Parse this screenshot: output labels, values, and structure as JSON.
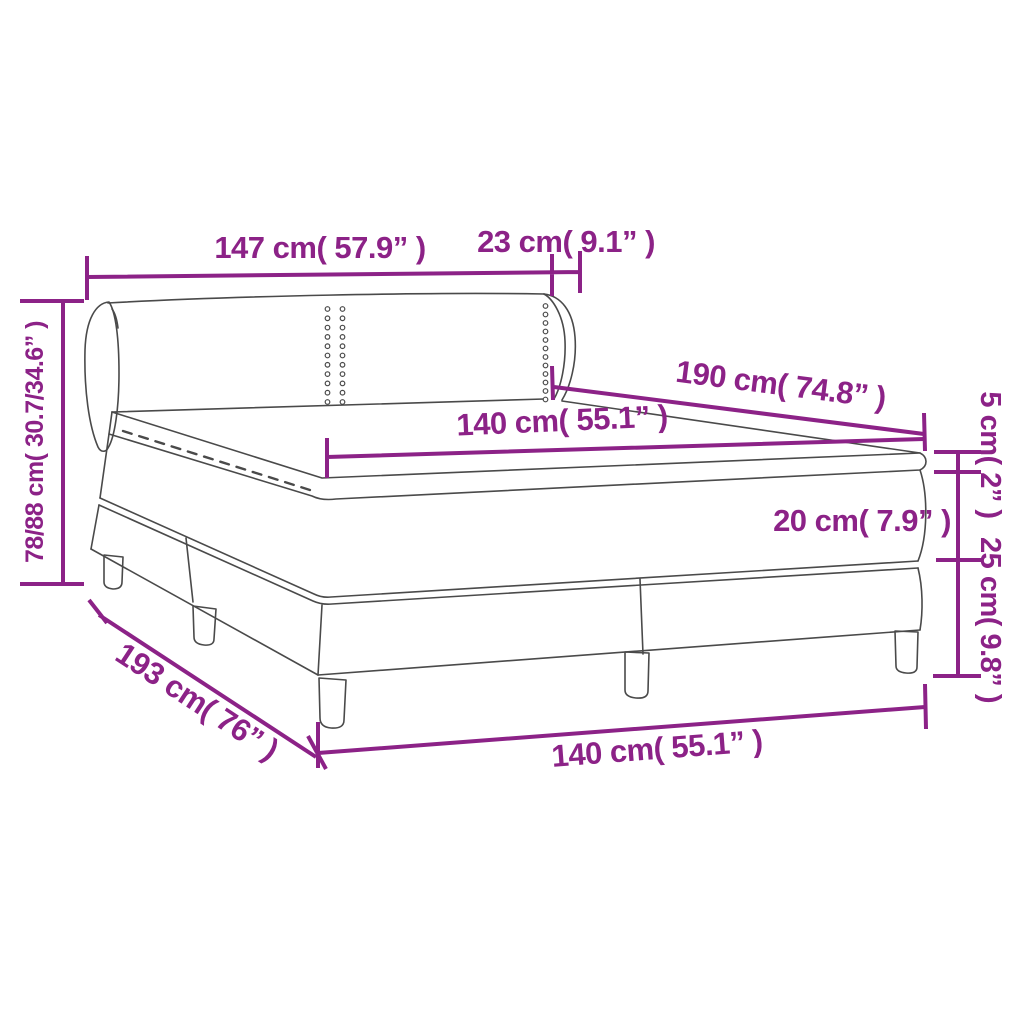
{
  "diagram": {
    "title": "box-spring-bed-dimension-diagram",
    "colors": {
      "accent": "#8C2287",
      "drawing_line": "#4A4A4A",
      "background": "#FFFFFF"
    },
    "labels": {
      "headboard_total_width": "147 cm( 57.9” )",
      "wing_depth": "23 cm( 9.1” )",
      "total_height": "78/88 cm( 30.7/34.6” )",
      "mattress_length": "190 cm( 74.8” )",
      "mattress_width": "140 cm( 55.1” )",
      "topper_height": "5 cm( 2” )",
      "mattress_height": "20 cm( 7.9” )",
      "base_height": "25 cm( 9.8” )",
      "total_length": "193 cm( 76” )",
      "base_width": "140 cm( 55.1” )"
    }
  }
}
